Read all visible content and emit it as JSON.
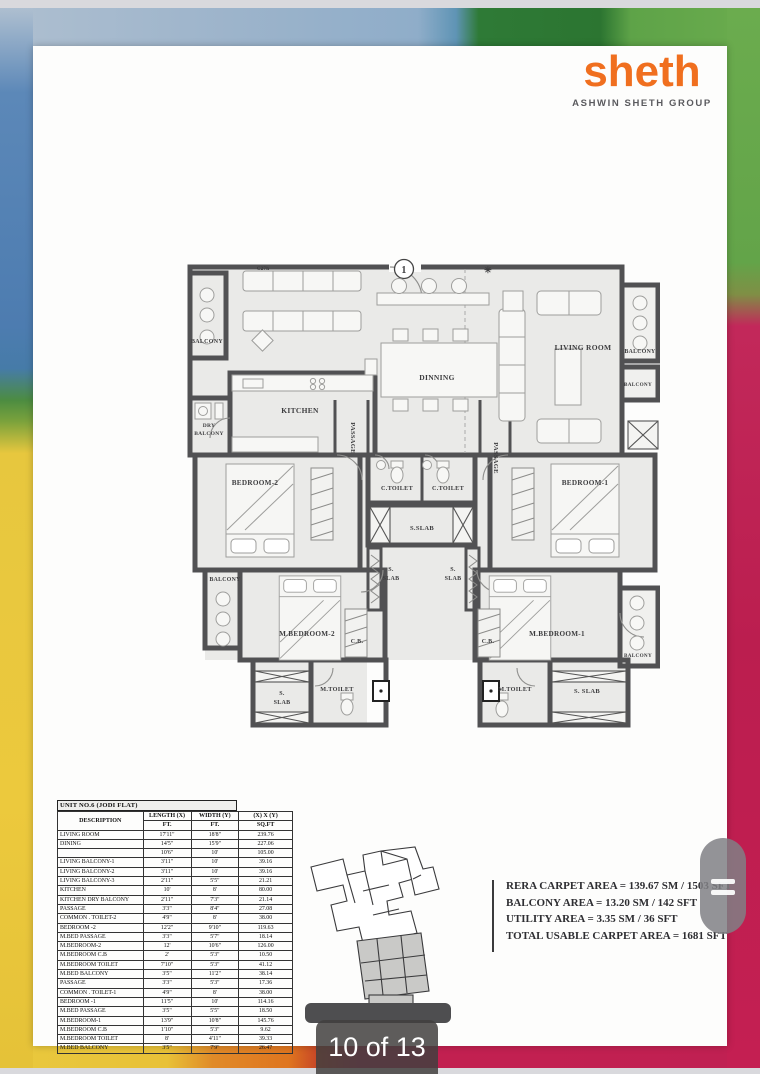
{
  "brand": {
    "logo": "sheth",
    "tagline": "ASHWIN SHETH GROUP",
    "logo_color": "#f06f1f"
  },
  "viewer": {
    "page_indicator": "10 of 13"
  },
  "floorplan": {
    "unit_circle_number": "1",
    "labels": [
      {
        "text": "C27h",
        "x": 78,
        "y": 17,
        "s": 5
      },
      {
        "text": "✳",
        "x": 303,
        "y": 20,
        "s": 9
      },
      {
        "text": "BALCONY",
        "x": 22,
        "y": 90,
        "s": 6
      },
      {
        "text": "KITCHEN",
        "x": 115,
        "y": 160,
        "s": 7.5
      },
      {
        "text": "DRY",
        "x": 24,
        "y": 174,
        "s": 5.5
      },
      {
        "text": "BALCONY",
        "x": 24,
        "y": 182,
        "s": 5.5
      },
      {
        "text": "DINNING",
        "x": 252,
        "y": 127,
        "s": 7.5
      },
      {
        "text": "PASSAGE",
        "x": 166,
        "y": 185,
        "s": 6.5,
        "rot": 90
      },
      {
        "text": "LIVING ROOM",
        "x": 398,
        "y": 97,
        "s": 7.5
      },
      {
        "text": "BALCONY",
        "x": 455,
        "y": 100,
        "s": 5.8
      },
      {
        "text": "BALCONY",
        "x": 453,
        "y": 133,
        "s": 5.2
      },
      {
        "text": "C.TOILET",
        "x": 212,
        "y": 237,
        "s": 6.2
      },
      {
        "text": "C.TOILET",
        "x": 263,
        "y": 237,
        "s": 6.2
      },
      {
        "text": "PASSAGE",
        "x": 309,
        "y": 205,
        "s": 6.5,
        "rot": 90
      },
      {
        "text": "BEDROOM-2",
        "x": 70,
        "y": 232,
        "s": 7.2
      },
      {
        "text": "BEDROOM-1",
        "x": 400,
        "y": 232,
        "s": 7.2
      },
      {
        "text": "S.SLAB",
        "x": 237,
        "y": 277,
        "s": 6.5
      },
      {
        "text": "S.",
        "x": 206,
        "y": 318,
        "s": 6
      },
      {
        "text": "SLAB",
        "x": 206,
        "y": 327,
        "s": 6
      },
      {
        "text": "S.",
        "x": 268,
        "y": 318,
        "s": 6
      },
      {
        "text": "SLAB",
        "x": 268,
        "y": 327,
        "s": 6
      },
      {
        "text": "BALCONY",
        "x": 40,
        "y": 328,
        "s": 5.8
      },
      {
        "text": "M.BEDROOM-2",
        "x": 122,
        "y": 383,
        "s": 7.2
      },
      {
        "text": "M.BEDROOM-1",
        "x": 372,
        "y": 383,
        "s": 7.2
      },
      {
        "text": "C.B.",
        "x": 172,
        "y": 390,
        "s": 6
      },
      {
        "text": "C.B.",
        "x": 303,
        "y": 390,
        "s": 6
      },
      {
        "text": "S.",
        "x": 97,
        "y": 442,
        "s": 6
      },
      {
        "text": "SLAB",
        "x": 97,
        "y": 451,
        "s": 6
      },
      {
        "text": "M.TOILET",
        "x": 152,
        "y": 438,
        "s": 6.2
      },
      {
        "text": "M.TOILET",
        "x": 330,
        "y": 438,
        "s": 6.2
      },
      {
        "text": "S. SLAB",
        "x": 402,
        "y": 440,
        "s": 6.5
      },
      {
        "text": "BALCONY",
        "x": 453,
        "y": 404,
        "s": 5.2
      }
    ]
  },
  "area_table": {
    "title": "UNIT NO.6 (JODI FLAT)",
    "col_desc": "DESCRIPTION",
    "col_len": "LENGTH (X)",
    "col_len_unit": "FT.",
    "col_wid": "WIDTH (Y)",
    "col_wid_unit": "FT.",
    "col_area": "(X) X (Y)",
    "col_area_unit": "SQ.FT",
    "rows": [
      [
        "LIVING ROOM",
        "17'11\"",
        "18'8\"",
        "239.76"
      ],
      [
        "DINING",
        "14'5\"",
        "15'9\"",
        "227.06"
      ],
      [
        "",
        "10'6\"",
        "10'",
        "105.00"
      ],
      [
        "LIVING BALCONY-1",
        "3'11\"",
        "10'",
        "39.16"
      ],
      [
        "LIVING BALCONY-2",
        "3'11\"",
        "10'",
        "39.16"
      ],
      [
        "LIVING BALCONY-3",
        "2'11\"",
        "5'5\"",
        "21.21"
      ],
      [
        "KITCHEN",
        "10'",
        "8'",
        "80.00"
      ],
      [
        "KITCHEN DRY BALCONY",
        "2'11\"",
        "7'3\"",
        "21.14"
      ],
      [
        "PASSAGE",
        "3'3\"",
        "8'4\"",
        "27.08"
      ],
      [
        "COMMON . TOILET-2",
        "4'9\"",
        "8'",
        "38.00"
      ],
      [
        "BEDROOM -2",
        "12'2\"",
        "9'10\"",
        "119.63"
      ],
      [
        "M.BED PASSAGE",
        "3'3\"",
        "5'7\"",
        "18.14"
      ],
      [
        "M.BEDROOM-2",
        "12'",
        "10'6\"",
        "126.00"
      ],
      [
        "M.BEDROOM C.B",
        "2'",
        "5'3\"",
        "10.50"
      ],
      [
        "M.BEDROOM TOILET",
        "7'10\"",
        "5'3\"",
        "41.12"
      ],
      [
        "M.BED BALCONY",
        "3'5\"",
        "11'2\"",
        "38.14"
      ],
      [
        "PASSAGE",
        "3'3\"",
        "5'3\"",
        "17.36"
      ],
      [
        "COMMON . TOILET-1",
        "4'9\"",
        "8'",
        "38.00"
      ],
      [
        "BEDROOM -1",
        "11'5\"",
        "10'",
        "114.16"
      ],
      [
        "M.BED PASSAGE",
        "3'5\"",
        "5'5\"",
        "18.50"
      ],
      [
        "M.BEDROOM-1",
        "13'9\"",
        "10'8\"",
        "145.76"
      ],
      [
        "M.BEDROOM C.B",
        "1'10\"",
        "5'3\"",
        "9.62"
      ],
      [
        "M.BEDROOM TOILET",
        "8'",
        "4'11\"",
        "39.33"
      ],
      [
        "M.BED BALCONY",
        "3'5\"",
        "7'9\"",
        "26.47"
      ]
    ]
  },
  "areas_summary": {
    "lines": [
      "RERA CARPET AREA = 139.67 SM / 1503 SFT",
      "BALCONY AREA = 13.20 SM / 142 SFT",
      "UTILITY AREA = 3.35 SM / 36 SFT",
      "TOTAL USABLE CARPET AREA = 1681 SFT"
    ]
  }
}
